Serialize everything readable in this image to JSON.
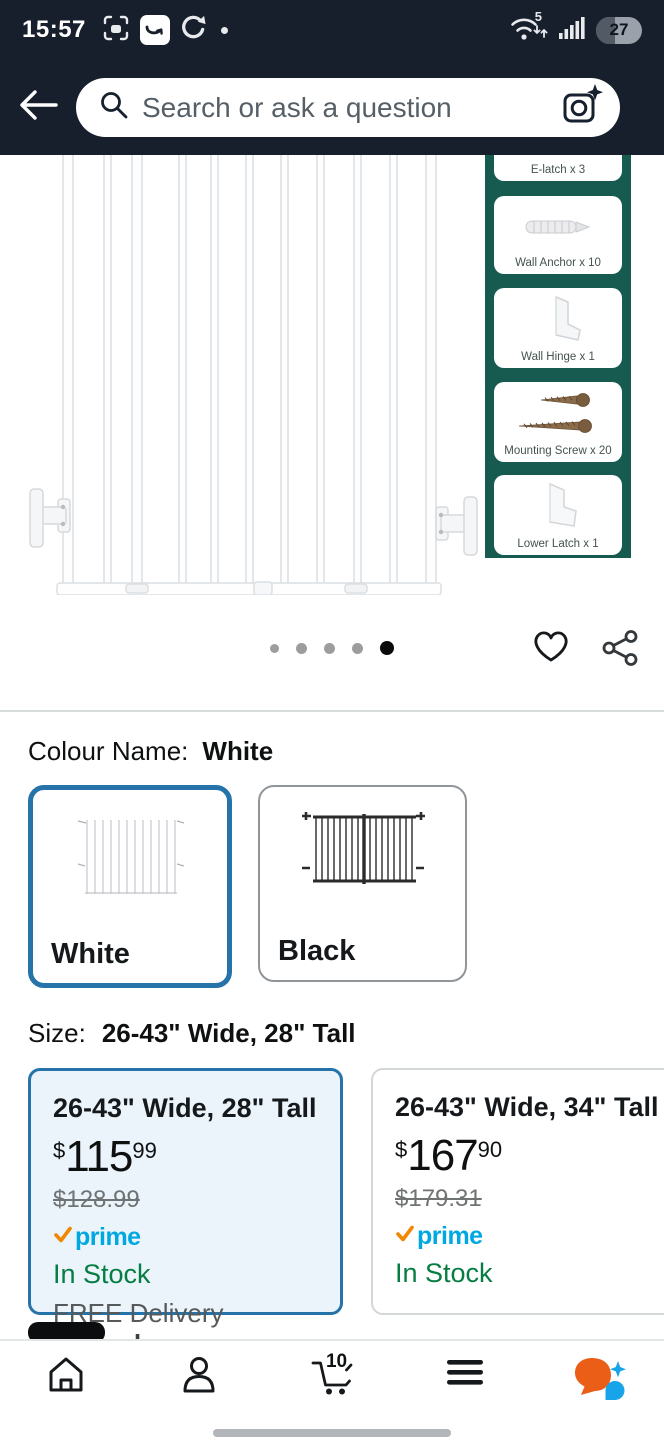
{
  "status_bar": {
    "time": "15:57",
    "wifi_badge": "5",
    "battery_percent": "27"
  },
  "header": {
    "search_placeholder": "Search or ask a question"
  },
  "parts_panel": {
    "items": [
      "E-latch x 3",
      "Wall Anchor x 10",
      "Wall Hinge x 1",
      "Mounting Screw x 20",
      "Lower Latch x 1"
    ]
  },
  "gallery": {
    "dot_count": 5,
    "active_dot": 5
  },
  "colour": {
    "label": "Colour Name:",
    "value": "White",
    "options": [
      {
        "name": "White",
        "selected": true
      },
      {
        "name": "Black",
        "selected": false
      }
    ]
  },
  "size": {
    "label": "Size:",
    "value": "26-43\" Wide, 28\" Tall"
  },
  "size_options": [
    {
      "title": "26-43\" Wide, 28\" Tall",
      "currency": "$",
      "price_whole": "115",
      "price_cents": "99",
      "list_price": "$128.99",
      "prime_label": "prime",
      "availability": "In Stock",
      "delivery_text": "FREE Delivery ",
      "delivery_emphasis": "Thursday",
      "selected": true
    },
    {
      "title": "26-43\" Wide, 34\" Tall",
      "currency": "$",
      "price_whole": "167",
      "price_cents": "90",
      "list_price": "$179.31",
      "prime_label": "prime",
      "availability": "In Stock",
      "selected": false
    }
  ],
  "bottom_nav": {
    "cart_count": "10"
  },
  "icons": {
    "status_left": [
      "screenshot-icon",
      "amazon-app-icon",
      "sync-icon",
      "notification-dot"
    ],
    "status_right": [
      "wifi-icon",
      "signal-icon",
      "battery-icon"
    ],
    "header": [
      "back-arrow-icon",
      "magnifier-icon",
      "camera-lens-icon"
    ],
    "gallery": [
      "heart-icon",
      "share-icon"
    ],
    "bottom_nav": [
      "home-icon",
      "profile-icon",
      "cart-icon",
      "menu-icon",
      "rufus-icon"
    ]
  },
  "colors": {
    "header_dark": "#171e2c",
    "panel_teal": "#175a50",
    "accent_blue": "#2573a9",
    "selected_fill": "#ebf4fb",
    "prime_blue": "#00a8e1",
    "prime_check_orange": "#f08804",
    "stock_green": "#067d42"
  }
}
